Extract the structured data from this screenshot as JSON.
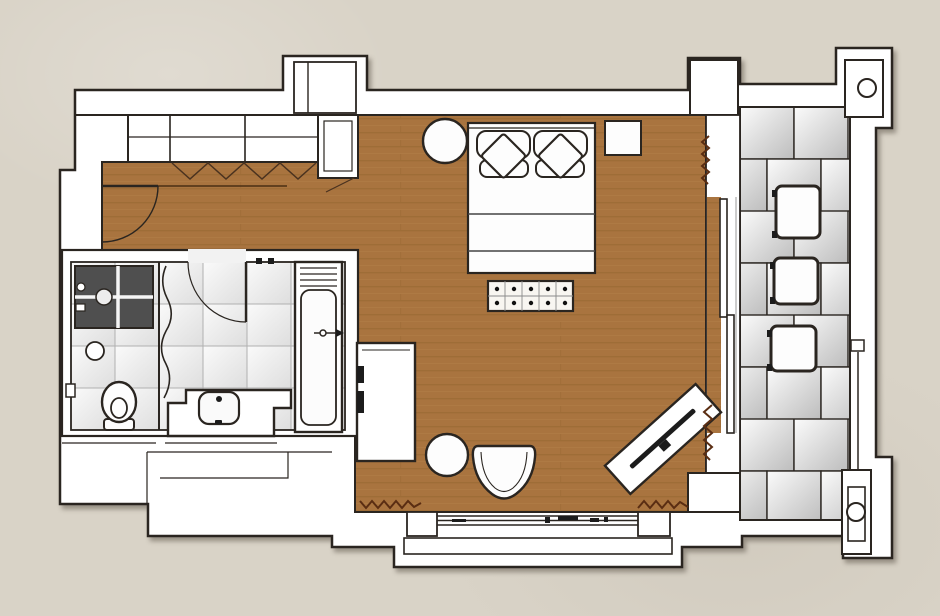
{
  "meta": {
    "kind": "architectural-floor-plan",
    "units": "none-visible",
    "text_labels": []
  },
  "colors": {
    "background": "#d9d3c7",
    "wall": "#ffffff",
    "outline": "#2a2520",
    "wood": "#a9743f",
    "wood_streak": "#93652f",
    "wood_light": "#b8824c",
    "bath_tile_a": "#fafafa",
    "bath_tile_b": "#dedede",
    "bath_tile_line": "#b0b0b0",
    "balcony_tile_light": "#fbfbfb",
    "balcony_tile_dark": "#bdbdbd",
    "shower_dark": "#4f4f4f",
    "curtain_mark": "#5a2d12",
    "floor_seam": "#4a2f14",
    "fixture_dark": "#1c1c1c"
  },
  "fixtures": [
    "entry-door",
    "wardrobe",
    "bifold-door-marks",
    "duct-shaft",
    "double-bed",
    "pillows",
    "round-side-table",
    "nightstand",
    "bed-end-bench",
    "desk",
    "round-stool",
    "armchair",
    "tv-console",
    "sliding-balcony-door",
    "window-bay",
    "curtain-marks",
    "balcony-terrace",
    "balcony-stools",
    "structural-columns",
    "bathroom",
    "shower",
    "shower-curtain",
    "toilet",
    "toilet-paper-holder",
    "sink-vanity",
    "bathtub",
    "bathtub-faucet"
  ]
}
